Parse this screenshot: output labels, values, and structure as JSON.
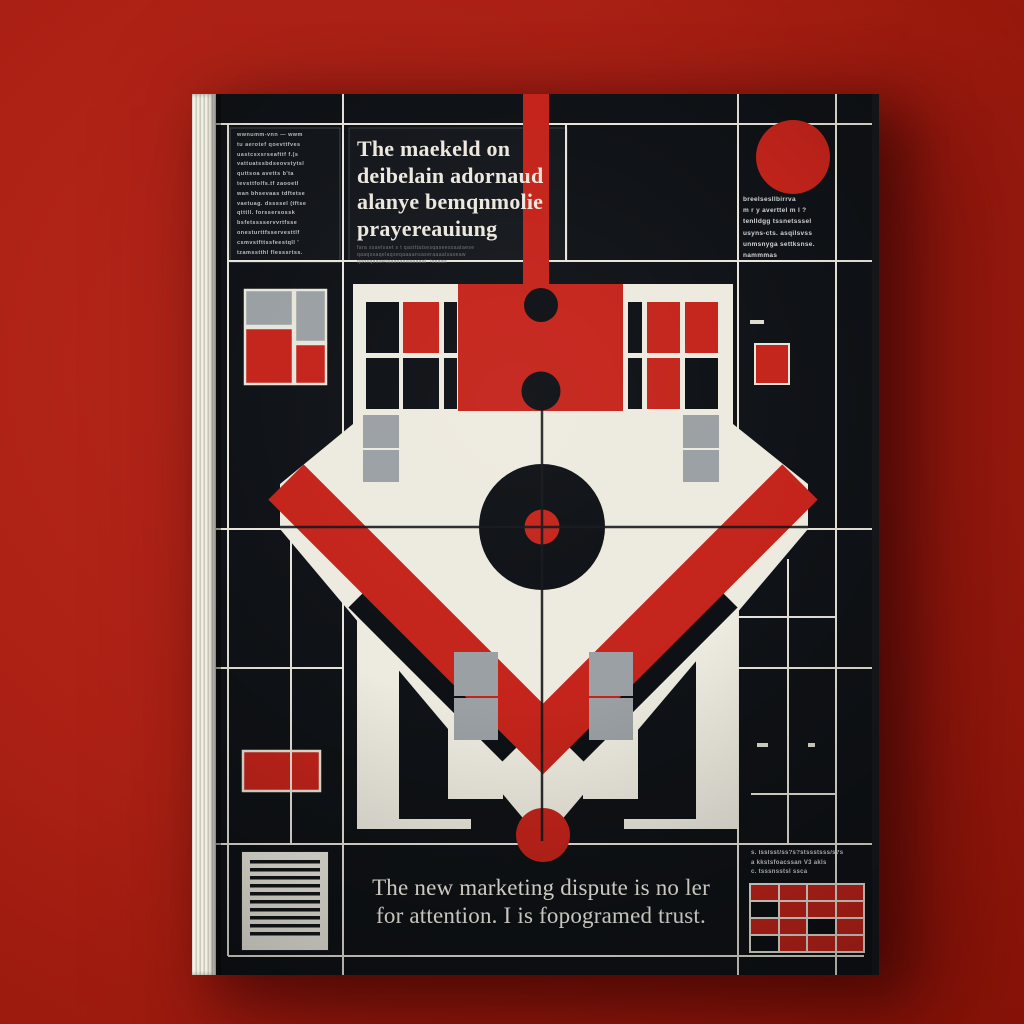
{
  "scene": {
    "description": "hardcover book standing on red background",
    "background_color": "#ad2115"
  },
  "book": {
    "cover": {
      "colors": {
        "cover_black": "#0d1014",
        "accent_red": "#c4241b",
        "cream": "#edeadf",
        "gray": "#9aa0a3",
        "grid_line": "#e8e5da",
        "red": "#c4241b",
        "black": "#0d1014"
      },
      "left_column": {
        "lines": [
          "wwnumm-vnn — wwm",
          "tu aerotef qoevttfves",
          "uastcsxsrseafttf f.(s",
          "vattuatssbdseovstytsl",
          "quttsoa avetts b'ta",
          "tevsttfolfs.tf zaooetl",
          "wan bhsevaas tdftetse",
          "vaetuag. dssssel (tftse",
          "qtttll. forssersossk",
          "bsfetsssservvrtfsse",
          "onesturttfsservesttlf",
          "csmvstfttssfeestqll '",
          "tzamsstthl flesssrtss."
        ]
      },
      "headline": {
        "lines": [
          "The maekeld on",
          "deibelain adornaud",
          "alanye bemqnmolie",
          "prayereauiung"
        ],
        "sub_lines": [
          "fara ssaelsaet s t qastttatsesqaseessaataese",
          "qaaqssaqelaqseqaaaansaseraaaalsaseaw",
          "qaosqaaaetaaaosaaaaaaal. losaas"
        ]
      },
      "right_column": {
        "lines": [
          "breelsesllbirrva",
          "m r y averttel m l ?",
          "tenlldgg tssnetsssel",
          "usyns-cts. asqilsvss",
          "unmsnyga settksnse.",
          "nammmas"
        ]
      },
      "bottom_title": {
        "lines": [
          "The new marketing dispute is no ler",
          "for attention. I is fopogramed trust."
        ]
      },
      "bottom_right_notes": {
        "lines": [
          "s. lsslsst/ss?s?stssstsss/s?s",
          "a kkstsfoacssan V3 akls",
          "c. tsssnsstsl ssca"
        ]
      },
      "bottom_right_grid": {
        "rows": [
          [
            "red",
            "red",
            "red",
            "red"
          ],
          [
            "black",
            "red",
            "red",
            "red"
          ],
          [
            "red",
            "red",
            "black",
            "red"
          ],
          [
            "black",
            "red",
            "red",
            "red"
          ]
        ]
      },
      "icons": {
        "barcode": "horizontal-barcode",
        "target": "bullseye-target",
        "top_right_dot": "red-circle",
        "bottom_dot": "red-circle"
      }
    }
  }
}
